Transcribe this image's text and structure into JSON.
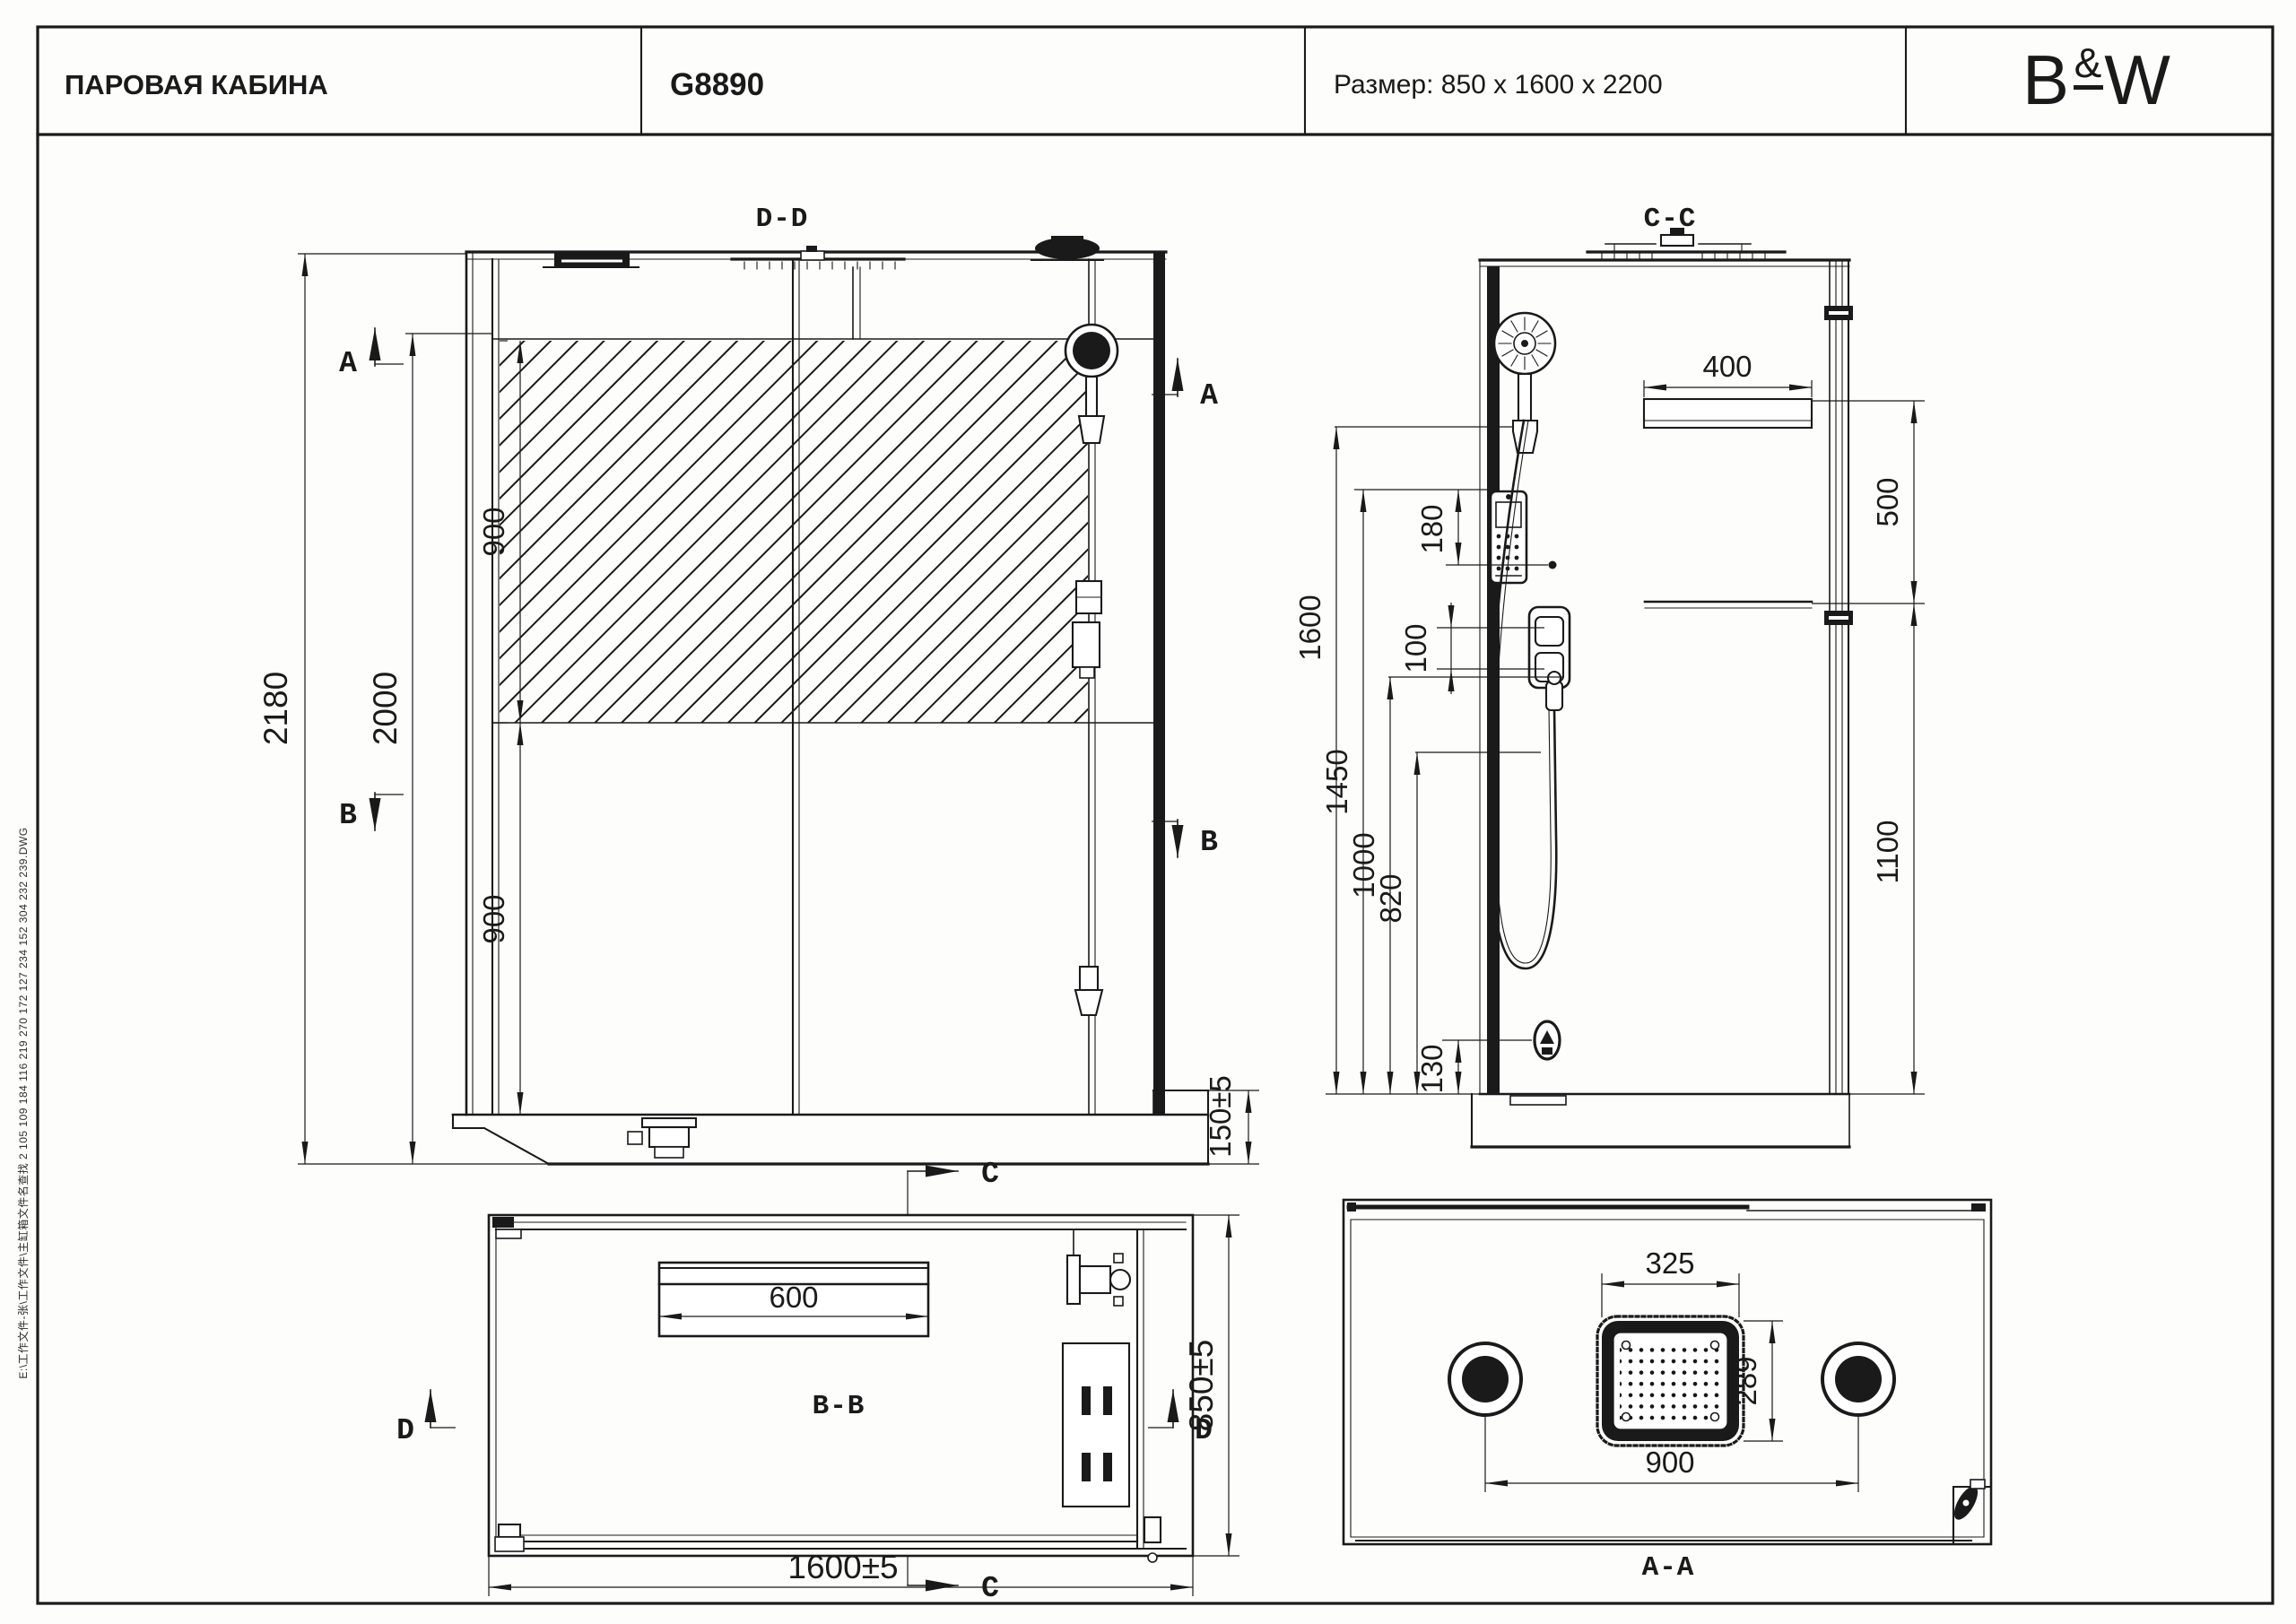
{
  "header": {
    "title": "ПАРОВАЯ КАБИНА",
    "model": "G8890",
    "size_label": "Размер: 850 x 1600 x 2200",
    "logo_b": "B",
    "logo_amp": "&",
    "logo_w": "W"
  },
  "note": "E:\\工作文件-张\\工作文件\\主缸箱文件名查找 2 105 109 184 116 219 270 172 127 234 152 304 232 239.DWG",
  "front_view": {
    "label": "D-D",
    "sec_a": "A",
    "sec_b": "B",
    "dim_total_height": "2180",
    "dim_inner_height": "2000",
    "dim_glass_upper": "900",
    "dim_glass_lower": "900",
    "dim_base_height": "150±5"
  },
  "side_view": {
    "label": "C-C",
    "dim_shelf_width": "400",
    "dim_shelf_spacing": "500",
    "dim_shelf_low": "1100",
    "dim_hand_shower_height": "1600",
    "dim_panel_height": "1450",
    "dim_panel_offset": "180",
    "dim_valve_spacing": "100",
    "dim_hose_height": "1000",
    "dim_spout_height": "820",
    "dim_steam_outlet_height": "130"
  },
  "plan_view": {
    "label": "B-B",
    "sec_c": "C",
    "sec_d": "D",
    "dim_seat_width": "600",
    "dim_width": "1600±5",
    "dim_depth": "850±5"
  },
  "ceiling_view": {
    "label": "A-A",
    "dim_head_width": "325",
    "dim_head_depth": "289",
    "dim_speaker_spacing": "900"
  }
}
